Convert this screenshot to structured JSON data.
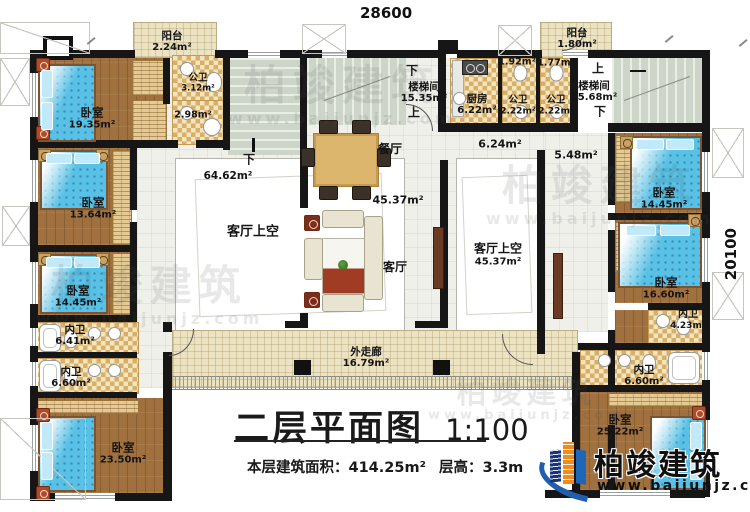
{
  "dimensions": {
    "top": "28600",
    "right": "20100"
  },
  "title": {
    "main": "二层平面图",
    "scale": "1:100",
    "area_label": "本层建筑面积：",
    "area_value": "414.25m²",
    "height_label": "层高：",
    "height_value": "3.3m"
  },
  "brand": {
    "name": "柏竣建筑",
    "website": "www.baijunjz.com"
  },
  "watermark": {
    "name": "柏竣建筑",
    "website": "www.baijunjz.com"
  },
  "colors": {
    "wall": "#161616",
    "wood": "#a0713f",
    "tile": "#d9ae67",
    "bed": "#58c1e5",
    "stair": "#ccd5c8",
    "corridor": "#ebe3c2",
    "logo_blue": "#1f5fae",
    "logo_orange": "#f08c1e"
  },
  "rooms": {
    "balcony_tl": {
      "label": "阳台",
      "area": "2.24m²"
    },
    "bedroom1": {
      "label": "卧室",
      "area": "19.35m²"
    },
    "pubbath_tl": {
      "label": "公卫",
      "area": "3.12m²"
    },
    "laundry": {
      "area": "2.98m²"
    },
    "bedroom2": {
      "label": "卧室",
      "area": "13.64m²"
    },
    "bedroom3": {
      "label": "卧室",
      "area": "14.45m²"
    },
    "innerbath1": {
      "label": "内卫",
      "area": "6.41m²"
    },
    "innerbath2": {
      "label": "内卫",
      "area": "6.60m²"
    },
    "bedroom4": {
      "label": "卧室",
      "area": "23.50m²"
    },
    "stair_left": {
      "label": "楼梯间",
      "area": "15.35m²",
      "up": "上",
      "down": "下"
    },
    "void_left": {
      "label": "客厅上空",
      "area": "64.62m²",
      "down": "下"
    },
    "dining": {
      "label": "餐厅"
    },
    "living": {
      "label": "客厅",
      "area": "45.37m²"
    },
    "kitchen": {
      "label": "厨房",
      "area": "6.22m²"
    },
    "wc_small1": {
      "area": "1.92m²"
    },
    "wc_small2": {
      "area": "1.77m²"
    },
    "pubbath_c1": {
      "label": "公卫",
      "area": "2.22m²"
    },
    "pubbath_c2": {
      "label": "公卫",
      "area": "2.22m²"
    },
    "hall_624": {
      "area": "6.24m²"
    },
    "hall_548": {
      "area": "5.48m²"
    },
    "stair_right": {
      "label": "楼梯间",
      "area": "15.68m²",
      "up": "上",
      "down": "下"
    },
    "balcony_tr": {
      "label": "阳台",
      "area": "1.80m²"
    },
    "void_right": {
      "label": "客厅上空",
      "area": "45.37m²"
    },
    "corridor": {
      "label": "外走廊",
      "area": "16.79m²"
    },
    "bedroom5": {
      "label": "卧室",
      "area": "14.45m²"
    },
    "bedroom6": {
      "label": "卧室",
      "area": "16.60m²"
    },
    "innerbath3": {
      "label": "内卫",
      "area": "4.23m²"
    },
    "innerbath4": {
      "label": "内卫",
      "area": "6.60m²"
    },
    "bedroom7": {
      "label": "卧室",
      "area": "25.22m²"
    }
  }
}
